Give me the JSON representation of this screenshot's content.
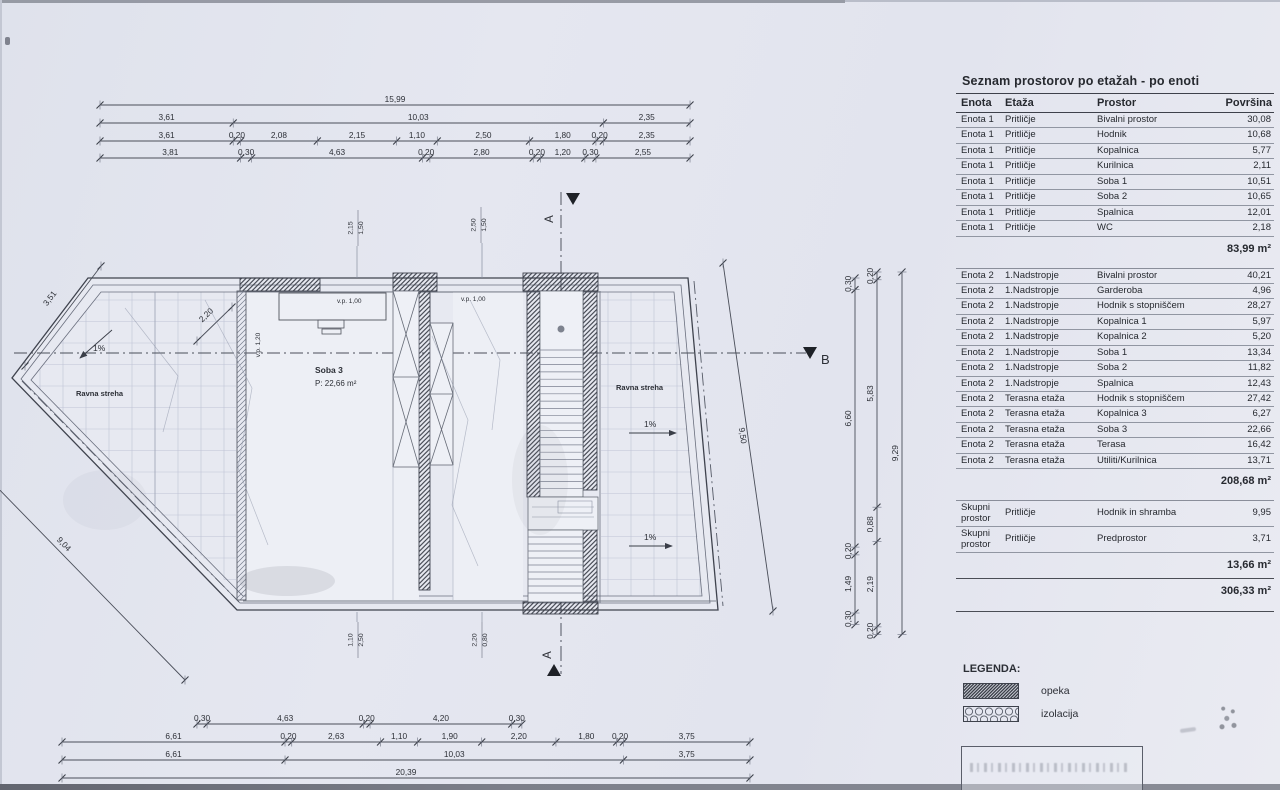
{
  "table": {
    "title": "Seznam prostorov po etažah - po enoti",
    "columns": [
      "Enota",
      "Etaža",
      "Prostor",
      "Površina"
    ],
    "sections": [
      {
        "rows": [
          [
            "Enota 1",
            "Pritličje",
            "Bivalni prostor",
            "30,08"
          ],
          [
            "Enota 1",
            "Pritličje",
            "Hodnik",
            "10,68"
          ],
          [
            "Enota 1",
            "Pritličje",
            "Kopalnica",
            "5,77"
          ],
          [
            "Enota 1",
            "Pritličje",
            "Kurilnica",
            "2,11"
          ],
          [
            "Enota 1",
            "Pritličje",
            "Soba 1",
            "10,51"
          ],
          [
            "Enota 1",
            "Pritličje",
            "Soba 2",
            "10,65"
          ],
          [
            "Enota 1",
            "Pritličje",
            "Spalnica",
            "12,01"
          ],
          [
            "Enota 1",
            "Pritličje",
            "WC",
            "2,18"
          ]
        ],
        "subtotal": "83,99 m²"
      },
      {
        "rows": [
          [
            "Enota 2",
            "1.Nadstropje",
            "Bivalni prostor",
            "40,21"
          ],
          [
            "Enota 2",
            "1.Nadstropje",
            "Garderoba",
            "4,96"
          ],
          [
            "Enota 2",
            "1.Nadstropje",
            "Hodnik s stopniščem",
            "28,27"
          ],
          [
            "Enota 2",
            "1.Nadstropje",
            "Kopalnica 1",
            "5,97"
          ],
          [
            "Enota 2",
            "1.Nadstropje",
            "Kopalnica 2",
            "5,20"
          ],
          [
            "Enota 2",
            "1.Nadstropje",
            "Soba 1",
            "13,34"
          ],
          [
            "Enota 2",
            "1.Nadstropje",
            "Soba 2",
            "11,82"
          ],
          [
            "Enota 2",
            "1.Nadstropje",
            "Spalnica",
            "12,43"
          ],
          [
            "Enota 2",
            "Terasna etaža",
            "Hodnik s stopniščem",
            "27,42"
          ],
          [
            "Enota 2",
            "Terasna etaža",
            "Kopalnica 3",
            "6,27"
          ],
          [
            "Enota 2",
            "Terasna etaža",
            "Soba 3",
            "22,66"
          ],
          [
            "Enota 2",
            "Terasna etaža",
            "Terasa",
            "16,42"
          ],
          [
            "Enota 2",
            "Terasna etaža",
            "Utiliti/Kurilnica",
            "13,71"
          ]
        ],
        "subtotal": "208,68 m²"
      },
      {
        "rows": [
          [
            "Skupni prostor",
            "Pritličje",
            "Hodnik in shramba",
            "9,95"
          ],
          [
            "Skupni prostor",
            "Pritličje",
            "Predprostor",
            "3,71"
          ]
        ],
        "subtotal": "13,66 m²"
      }
    ],
    "grand_total": "306,33 m²"
  },
  "legend": {
    "title": "LEGENDA:",
    "items": [
      {
        "label": "opeka",
        "pattern": "brick-hatch"
      },
      {
        "label": "izolacija",
        "pattern": "insulation-loops"
      }
    ]
  },
  "plan": {
    "labels": {
      "room": "Soba 3",
      "room_area": "P: 22,66 m²",
      "flat_roof_left": "Ravna streha",
      "flat_roof_right": "Ravna streha",
      "slope_left": "1%",
      "slope_right_1": "1%",
      "slope_right_2": "1%",
      "vp100_a": "v.p. 1,00",
      "vp100_b": "v.p. 1,00",
      "vp120": "v.p. 1,20",
      "section_a_top": "A",
      "section_a_bottom": "A",
      "section_b": "B"
    },
    "dims": {
      "top": [
        [
          "15,99"
        ],
        [
          "3,61",
          "10,03",
          "2,35"
        ],
        [
          "3,61",
          "0,20",
          "2,08",
          "2,15",
          "1,10",
          "2,50",
          "1,80",
          "0,20",
          "2,35"
        ],
        [
          "3,81",
          "0,30",
          "4,63",
          "0,20",
          "2,80",
          "0,20",
          "1,20",
          "0,30",
          "2,55"
        ]
      ],
      "bottom": [
        [
          "0,30",
          "4,63",
          "0,20",
          "4,20",
          "0,30"
        ],
        [
          "6,61",
          "0,20",
          "2,63",
          "1,10",
          "1,90",
          "2,20",
          "1,80",
          "0,20",
          "3,75"
        ],
        [
          "6,61",
          "10,03",
          "3,75"
        ],
        [
          "20,39"
        ]
      ],
      "right": [
        [
          "0,30",
          "6,60",
          "0,20",
          "1,49",
          "0,30"
        ],
        [
          "0,20",
          "5,83",
          "0,88",
          "2,19",
          "0,20"
        ],
        [
          "9,29"
        ]
      ],
      "diagonals": {
        "upper_left": "3,51",
        "lower_left": "9,04",
        "right_edge": "9,50",
        "inner_left": "2,20"
      },
      "window_pairs": [
        [
          "2,15",
          "1,50"
        ],
        [
          "2,50",
          "1,50"
        ],
        [
          "1,10",
          "2,50"
        ],
        [
          "2,20",
          "0,80"
        ]
      ]
    }
  }
}
